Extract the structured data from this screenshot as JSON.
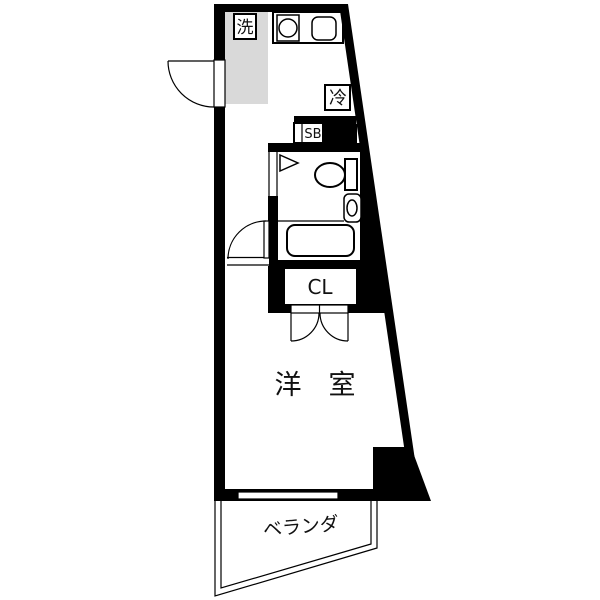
{
  "floorplan": {
    "labels": {
      "washer": "洗",
      "fridge": "冷",
      "shoe_box": "SB",
      "closet": "CL",
      "western_room": "洋　室",
      "balcony": "ベランダ"
    },
    "colors": {
      "wall": "#000000",
      "floor": "#ffffff",
      "shade": "#d9d9d9",
      "line": "#000000"
    }
  }
}
